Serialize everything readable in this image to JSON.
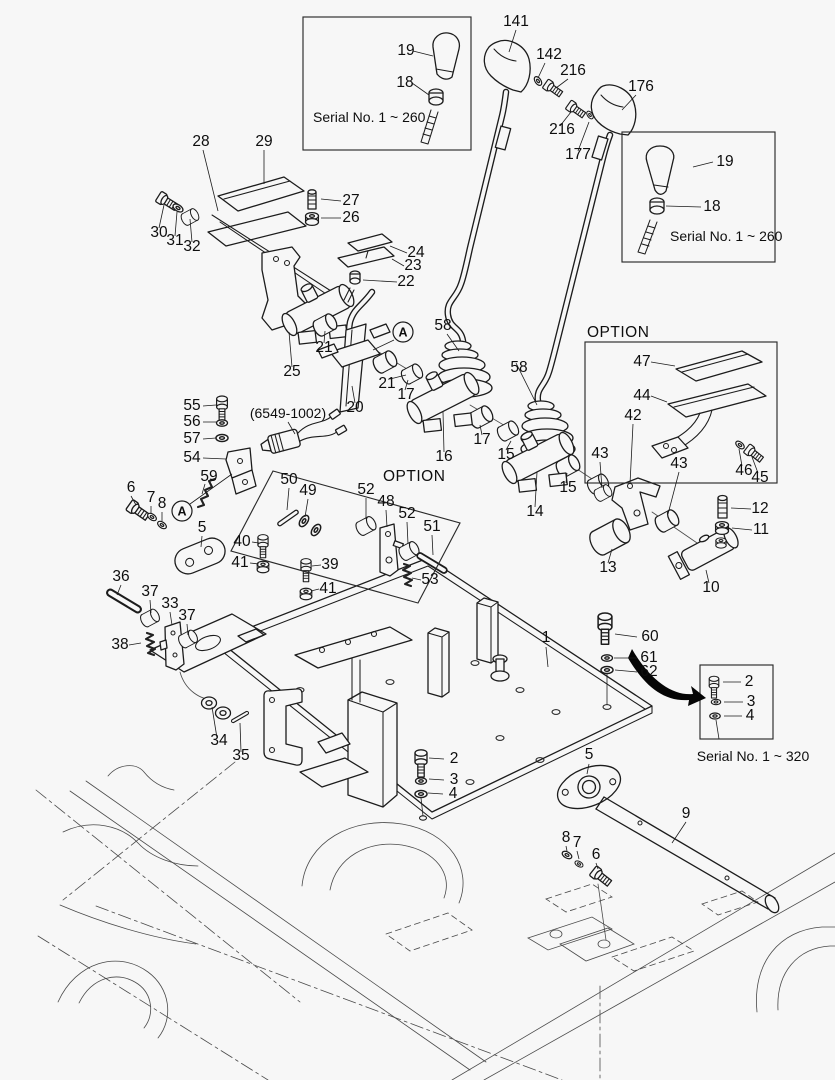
{
  "diagram": {
    "background": "#f7f7f7",
    "line_color": "#1c1c1c",
    "thin_line_color": "#4a4a4a",
    "text_color": "#0e0e0e",
    "boxes": {
      "serial_top_left": {
        "label": "Serial No. 1 ~ 260"
      },
      "serial_right": {
        "label": "Serial No. 1 ~ 260"
      },
      "option_right": {
        "label": "OPTION"
      },
      "option_left": {
        "label": "OPTION"
      },
      "serial_bottom_right": {
        "label": "Serial No. 1 ~ 320"
      }
    },
    "reference_code": "(6549-1002)",
    "markers": [
      {
        "label": "A",
        "x": 403,
        "y": 332
      },
      {
        "label": "A",
        "x": 182,
        "y": 511
      }
    ],
    "callouts": [
      {
        "n": "141",
        "x": 516,
        "y": 26
      },
      {
        "n": "142",
        "x": 549,
        "y": 59
      },
      {
        "n": "216",
        "x": 573,
        "y": 75
      },
      {
        "n": "176",
        "x": 641,
        "y": 91
      },
      {
        "n": "216",
        "x": 562,
        "y": 134
      },
      {
        "n": "177",
        "x": 578,
        "y": 159
      },
      {
        "n": "19",
        "x": 406,
        "y": 55
      },
      {
        "n": "18",
        "x": 405,
        "y": 87
      },
      {
        "n": "19",
        "x": 725,
        "y": 166
      },
      {
        "n": "18",
        "x": 712,
        "y": 211
      },
      {
        "n": "28",
        "x": 201,
        "y": 146
      },
      {
        "n": "29",
        "x": 264,
        "y": 146
      },
      {
        "n": "30",
        "x": 159,
        "y": 237
      },
      {
        "n": "31",
        "x": 175,
        "y": 245
      },
      {
        "n": "32",
        "x": 192,
        "y": 251
      },
      {
        "n": "27",
        "x": 351,
        "y": 205
      },
      {
        "n": "26",
        "x": 351,
        "y": 222
      },
      {
        "n": "24",
        "x": 416,
        "y": 257
      },
      {
        "n": "23",
        "x": 413,
        "y": 270
      },
      {
        "n": "22",
        "x": 406,
        "y": 286
      },
      {
        "n": "58",
        "x": 443,
        "y": 330
      },
      {
        "n": "21",
        "x": 324,
        "y": 352
      },
      {
        "n": "25",
        "x": 292,
        "y": 376
      },
      {
        "n": "21",
        "x": 387,
        "y": 388
      },
      {
        "n": "20",
        "x": 355,
        "y": 412
      },
      {
        "n": "17",
        "x": 406,
        "y": 399
      },
      {
        "n": "58",
        "x": 519,
        "y": 372
      },
      {
        "n": "17",
        "x": 482,
        "y": 444
      },
      {
        "n": "16",
        "x": 444,
        "y": 461
      },
      {
        "n": "15",
        "x": 506,
        "y": 459
      },
      {
        "n": "15",
        "x": 568,
        "y": 492
      },
      {
        "n": "14",
        "x": 535,
        "y": 516
      },
      {
        "n": "47",
        "x": 642,
        "y": 366
      },
      {
        "n": "44",
        "x": 642,
        "y": 400
      },
      {
        "n": "42",
        "x": 633,
        "y": 420
      },
      {
        "n": "43",
        "x": 600,
        "y": 458
      },
      {
        "n": "43",
        "x": 679,
        "y": 468
      },
      {
        "n": "46",
        "x": 744,
        "y": 475
      },
      {
        "n": "45",
        "x": 760,
        "y": 482
      },
      {
        "n": "12",
        "x": 760,
        "y": 513
      },
      {
        "n": "11",
        "x": 761,
        "y": 534
      },
      {
        "n": "13",
        "x": 608,
        "y": 572
      },
      {
        "n": "10",
        "x": 711,
        "y": 592
      },
      {
        "n": "55",
        "x": 192,
        "y": 410
      },
      {
        "n": "56",
        "x": 192,
        "y": 426
      },
      {
        "n": "57",
        "x": 192,
        "y": 443
      },
      {
        "n": "54",
        "x": 192,
        "y": 462
      },
      {
        "n": "59",
        "x": 209,
        "y": 481
      },
      {
        "n": "6",
        "x": 131,
        "y": 492
      },
      {
        "n": "7",
        "x": 151,
        "y": 502
      },
      {
        "n": "8",
        "x": 162,
        "y": 508
      },
      {
        "n": "5",
        "x": 202,
        "y": 532
      },
      {
        "n": "40",
        "x": 242,
        "y": 546
      },
      {
        "n": "41",
        "x": 240,
        "y": 567
      },
      {
        "n": "50",
        "x": 289,
        "y": 484
      },
      {
        "n": "49",
        "x": 308,
        "y": 495
      },
      {
        "n": "52",
        "x": 366,
        "y": 494
      },
      {
        "n": "48",
        "x": 386,
        "y": 506
      },
      {
        "n": "52",
        "x": 407,
        "y": 518
      },
      {
        "n": "51",
        "x": 432,
        "y": 531
      },
      {
        "n": "53",
        "x": 430,
        "y": 584
      },
      {
        "n": "39",
        "x": 330,
        "y": 569
      },
      {
        "n": "41",
        "x": 328,
        "y": 593
      },
      {
        "n": "36",
        "x": 121,
        "y": 581
      },
      {
        "n": "37",
        "x": 150,
        "y": 596
      },
      {
        "n": "33",
        "x": 170,
        "y": 608
      },
      {
        "n": "37",
        "x": 187,
        "y": 620
      },
      {
        "n": "38",
        "x": 120,
        "y": 649
      },
      {
        "n": "34",
        "x": 219,
        "y": 745
      },
      {
        "n": "35",
        "x": 241,
        "y": 760
      },
      {
        "n": "1",
        "x": 546,
        "y": 642
      },
      {
        "n": "60",
        "x": 650,
        "y": 641
      },
      {
        "n": "61",
        "x": 649,
        "y": 662
      },
      {
        "n": "62",
        "x": 649,
        "y": 676
      },
      {
        "n": "2",
        "x": 749,
        "y": 686
      },
      {
        "n": "3",
        "x": 751,
        "y": 706
      },
      {
        "n": "4",
        "x": 750,
        "y": 720
      },
      {
        "n": "2",
        "x": 454,
        "y": 763
      },
      {
        "n": "3",
        "x": 454,
        "y": 784
      },
      {
        "n": "4",
        "x": 453,
        "y": 798
      },
      {
        "n": "5",
        "x": 589,
        "y": 759
      },
      {
        "n": "8",
        "x": 566,
        "y": 842
      },
      {
        "n": "7",
        "x": 577,
        "y": 847
      },
      {
        "n": "6",
        "x": 596,
        "y": 859
      },
      {
        "n": "9",
        "x": 686,
        "y": 818
      }
    ]
  }
}
